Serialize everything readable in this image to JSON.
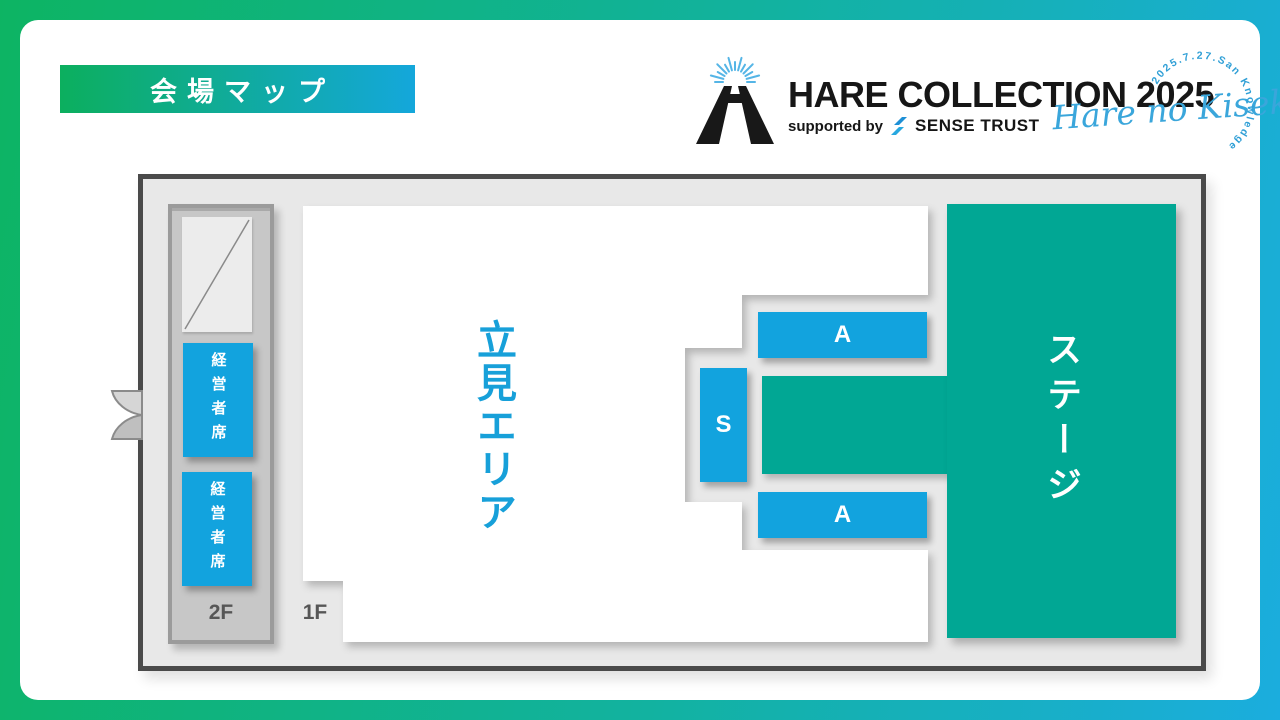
{
  "badge": {
    "label": "会場マップ"
  },
  "logo": {
    "title": "HARE COLLECTION 2025",
    "supported_prefix": "supported by",
    "sponsor_name": "SENSE TRUST",
    "tagline_script": "Hare no Kiseki",
    "arc_text": "2025.7.27.San Knowledge"
  },
  "map": {
    "floors": {
      "second": "2F",
      "first": "1F"
    },
    "areas": {
      "standing": "立見エリア",
      "stage": "ステージ"
    },
    "seats": {
      "executive_upper": "経営者席",
      "executive_lower": "経営者席",
      "s_block": "S",
      "a_block_front": "A",
      "a_block_rear": "A"
    }
  },
  "colors": {
    "accent_blue": "#12a3de",
    "accent_teal": "#01a794",
    "frame_gradient_start": "#0db463",
    "frame_gradient_end": "#1badde",
    "map_background": "#e8e8e8",
    "map_border": "#4a4a4a"
  }
}
